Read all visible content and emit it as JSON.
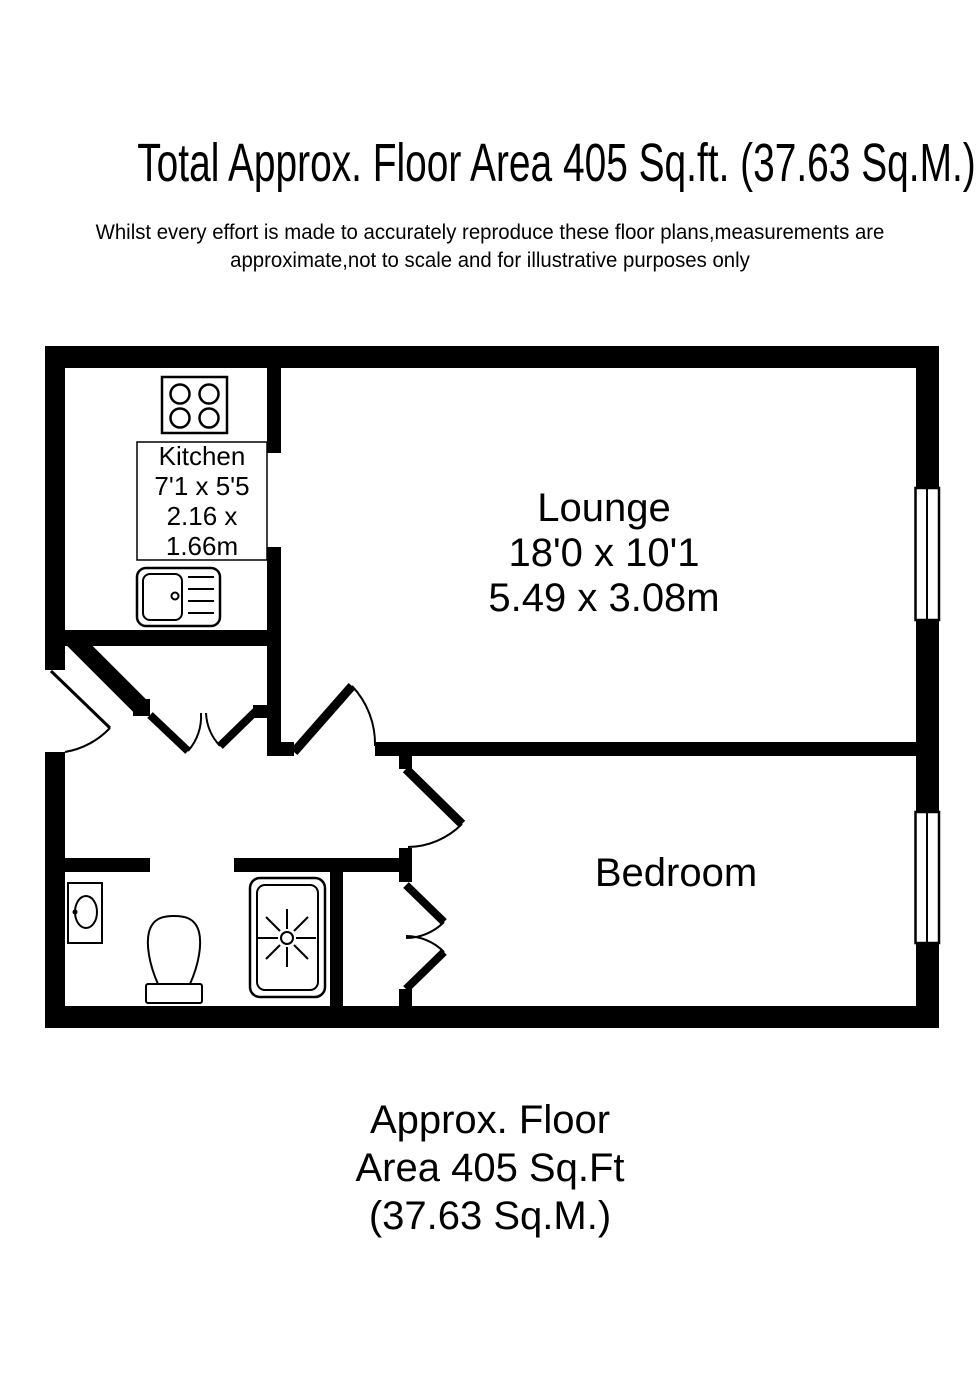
{
  "header": {
    "title": "Total Approx. Floor Area 405 Sq.ft. (37.63 Sq.M.)"
  },
  "disclaimer": {
    "line1": "Whilst every effort is made to accurately reproduce these floor plans,measurements are",
    "line2": "approximate,not to scale and for illustrative purposes only"
  },
  "floorplan": {
    "rooms": {
      "kitchen": {
        "name": "Kitchen",
        "imperial": "7'1 x 5'5",
        "metric": "2.16 x 1.66m"
      },
      "lounge": {
        "name": "Lounge",
        "imperial": "18'0 x 10'1",
        "metric": "5.49 x 3.08m"
      },
      "bedroom": {
        "name": "Bedroom"
      }
    },
    "fixtures": [
      "hob-icon",
      "sink-icon",
      "wash-basin-icon",
      "toilet-icon",
      "shower-icon"
    ],
    "features": [
      "entrance-door",
      "double-doors-hall",
      "lounge-door",
      "bedroom-door",
      "wardrobe-double-doors",
      "lounge-window",
      "bedroom-window"
    ],
    "colors": {
      "wall": "#000000",
      "background": "#ffffff"
    }
  },
  "footer": {
    "line1": "Approx. Floor",
    "line2": "Area 405 Sq.Ft",
    "line3": "(37.63 Sq.M.)"
  }
}
